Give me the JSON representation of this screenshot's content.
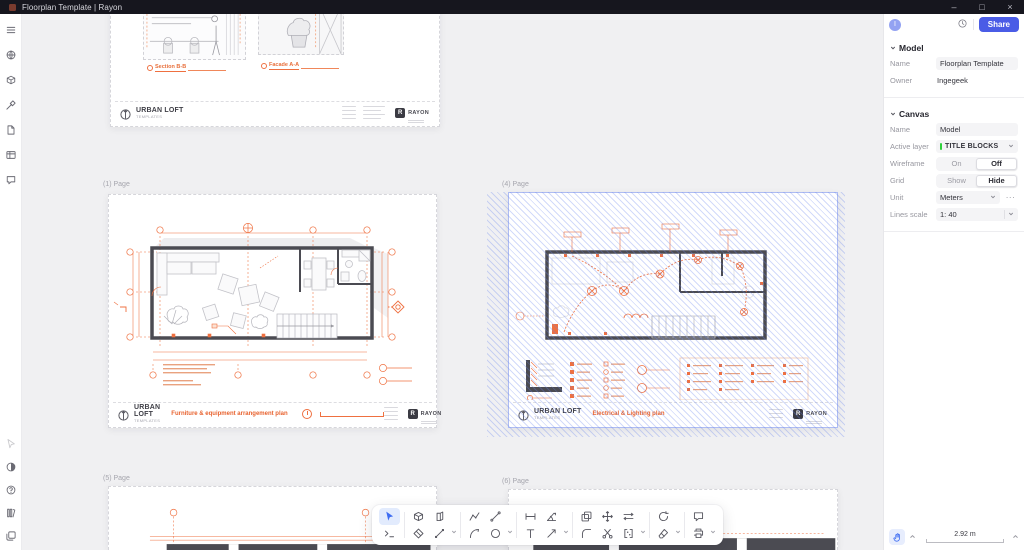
{
  "colors": {
    "accent": "#4a5ce6",
    "selection_blue": "#6884ee",
    "drawing_orange": "#e8622e",
    "wall_gray": "#4a4a50",
    "layer_green": "#2fd03c"
  },
  "titlebar": {
    "title": "Floorplan Template | Rayon",
    "minimize": "–",
    "maximize": "□",
    "close": "×"
  },
  "sidebar": {
    "top_icons": [
      "menu",
      "globe",
      "model",
      "design",
      "pages",
      "tables",
      "comments"
    ],
    "bottom_icons": [
      "pointer",
      "theme",
      "help",
      "library",
      "copies"
    ]
  },
  "canvas": {
    "top_page": {
      "section_label": "Section B-B",
      "facade_label": "Facade A-A",
      "brand": "URBAN LOFT",
      "brand_sub": "TEMPLATES",
      "logo_letter": "R",
      "logo_name": "RAYON"
    },
    "page1": {
      "label": "(1) Page",
      "plan_title": "Furniture & equipment arrangement plan",
      "brand": "URBAN LOFT",
      "brand_sub": "TEMPLATES",
      "logo_letter": "R",
      "logo_name": "RAYON"
    },
    "page4": {
      "label": "(4) Page",
      "plan_title": "Electrical & Lighting plan",
      "brand": "URBAN LOFT",
      "brand_sub": "TEMPLATES",
      "logo_letter": "R",
      "logo_name": "RAYON",
      "selected": true
    },
    "page5": {
      "label": "(5) Page"
    },
    "page6": {
      "label": "(6) Page"
    }
  },
  "toolbar": {
    "selected_tool": "select",
    "tools_row1": [
      "select",
      "volume",
      "wall",
      "polyline",
      "line",
      "linear-dimension",
      "angular-dimension",
      "copy",
      "move",
      "offset",
      "rotate",
      "comment"
    ],
    "tools_row2": [
      "prompt",
      "hatch",
      "segment",
      "arc",
      "circle",
      "text",
      "leader",
      "fillet",
      "split",
      "array",
      "eraser",
      "export"
    ]
  },
  "right_panel": {
    "avatar": "I",
    "share_label": "Share",
    "model": {
      "title": "Model",
      "name_label": "Name",
      "name_value": "Floorplan Template",
      "owner_label": "Owner",
      "owner_value": "Ingegeek"
    },
    "canvas_props": {
      "title": "Canvas",
      "name_label": "Name",
      "name_value": "Model",
      "active_layer_label": "Active layer",
      "active_layer_value": "TITLE BLOCKS",
      "wireframe_label": "Wireframe",
      "wireframe_on": "On",
      "wireframe_off": "Off",
      "wireframe_selected": "Off",
      "grid_label": "Grid",
      "grid_show": "Show",
      "grid_hide": "Hide",
      "grid_selected": "Hide",
      "unit_label": "Unit",
      "unit_value": "Meters",
      "unit_more": "···",
      "lines_scale_label": "Lines scale",
      "lines_scale_value": "1: 40"
    }
  },
  "statusbar": {
    "scale_value": "2.92 m"
  }
}
